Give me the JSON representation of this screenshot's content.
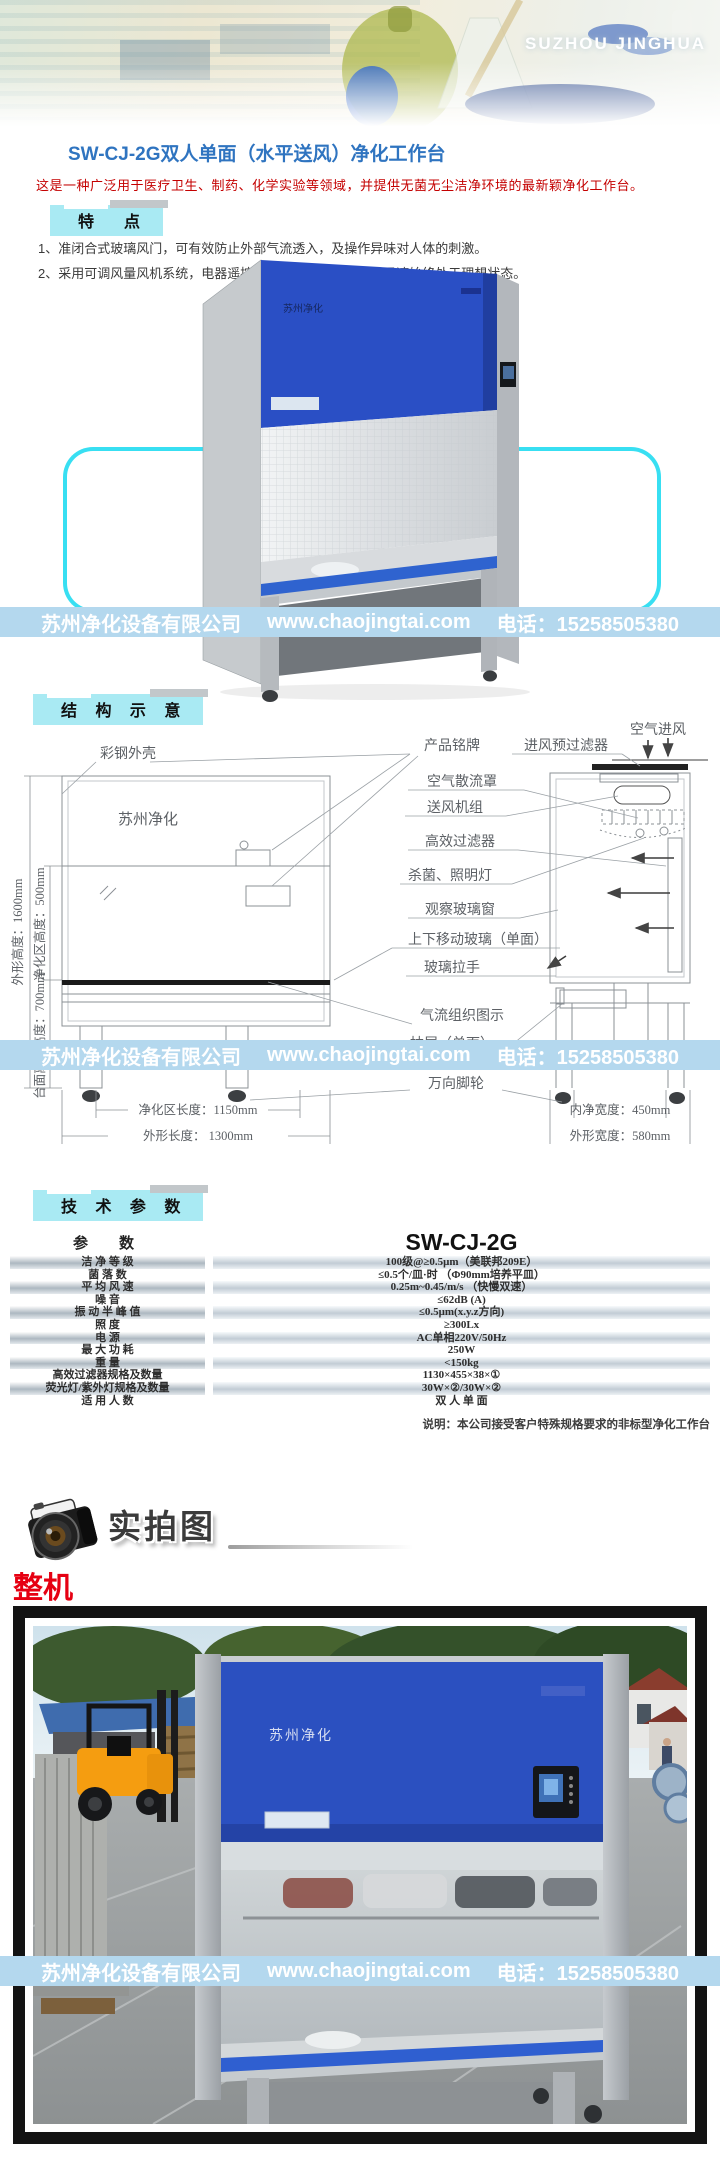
{
  "brand_banner": {
    "text": "SUZHOU JINGHUA"
  },
  "brand_cn": "苏州净化",
  "product": {
    "title": "SW-CJ-2G双人单面（水平送风）净化工作台",
    "intro": "这是一种广泛用于医疗卫生、制药、化学实验等领域，并提供无菌无尘洁净环境的最新颖净化工作台。"
  },
  "section_headers": {
    "features": "特　点",
    "structure": "结 构 示 意",
    "specs": "技 术 参 数"
  },
  "features": {
    "items": [
      "1、准闭合式玻璃风门，可有效防止外部气流透入，及操作异味对人体的刺激。",
      "2、采用可调风量风机系统，电器遥控开关控制。保证工作区风速始终处于理想状态。"
    ]
  },
  "watermark": {
    "company": "苏州净化设备有限公司",
    "website": "www.chaojingtai.com",
    "phone": "电话：15258505380"
  },
  "diagram": {
    "labels": {
      "shell": "彩钢外壳",
      "nameplate": "产品铭牌",
      "prefilter": "进风预过滤器",
      "air_inlet": "空气进风",
      "diffuser": "空气散流罩",
      "fan_unit": "送风机组",
      "hepa_filter": "高效过滤器",
      "lamps": "杀菌、照明灯",
      "window": "观察玻璃窗",
      "moving_glass": "上下移动玻璃（单面）",
      "handle": "玻璃拉手",
      "airflow": "气流组织图示",
      "drawer": "抽屉（单面）",
      "casters": "万向脚轮"
    },
    "dimensions": {
      "outer_height": "外形高度：1600mm",
      "clean_height": "净化区高度：500mm",
      "table_height": "台面离地高度：700mm",
      "clean_length": "净化区长度：1150mm",
      "outer_length": "外形长度： 1300mm",
      "inner_width": "内净宽度：450mm",
      "outer_width": "外形宽度：580mm"
    }
  },
  "spec_table": {
    "header": {
      "param": "参　数",
      "model": "SW-CJ-2G"
    },
    "rows": [
      {
        "label": "洁 净 等 级",
        "value": "100级@≥0.5μm（美联邦209E）"
      },
      {
        "label": "菌 落 数",
        "value": "≤0.5个/皿·时 （Φ90mm培养平皿）"
      },
      {
        "label": "平 均 风 速",
        "value": "0.25m~0.45/m/s （快慢双速）"
      },
      {
        "label": "噪  音",
        "value": "≤62dB (A)"
      },
      {
        "label": "振 动 半 峰 值",
        "value": "≤0.5μm(x.y.z方向)"
      },
      {
        "label": "照  度",
        "value": "≥300Lx"
      },
      {
        "label": "电  源",
        "value": "AC单相220V/50Hz"
      },
      {
        "label": "最 大 功 耗",
        "value": "250W"
      },
      {
        "label": "重  量",
        "value": "<150kg"
      },
      {
        "label": "高效过滤器规格及数量",
        "value": "1130×455×38×①"
      },
      {
        "label": "荧光灯/紫外灯规格及数量",
        "value": "30W×②/30W×②"
      },
      {
        "label": "适 用 人 数",
        "value": "双 人 单 面"
      }
    ],
    "note": "说明：本公司接受客户特殊规格要求的非标型净化工作台"
  },
  "photos": {
    "heading": "实拍图",
    "caption": "整机"
  },
  "colors": {
    "accent_cyan": "#a9eaf3",
    "watermark_bg": "#b4d8ee",
    "title_blue": "#2f74c0",
    "alert_red": "#c40000",
    "bench_blue": "#2b50c4"
  }
}
